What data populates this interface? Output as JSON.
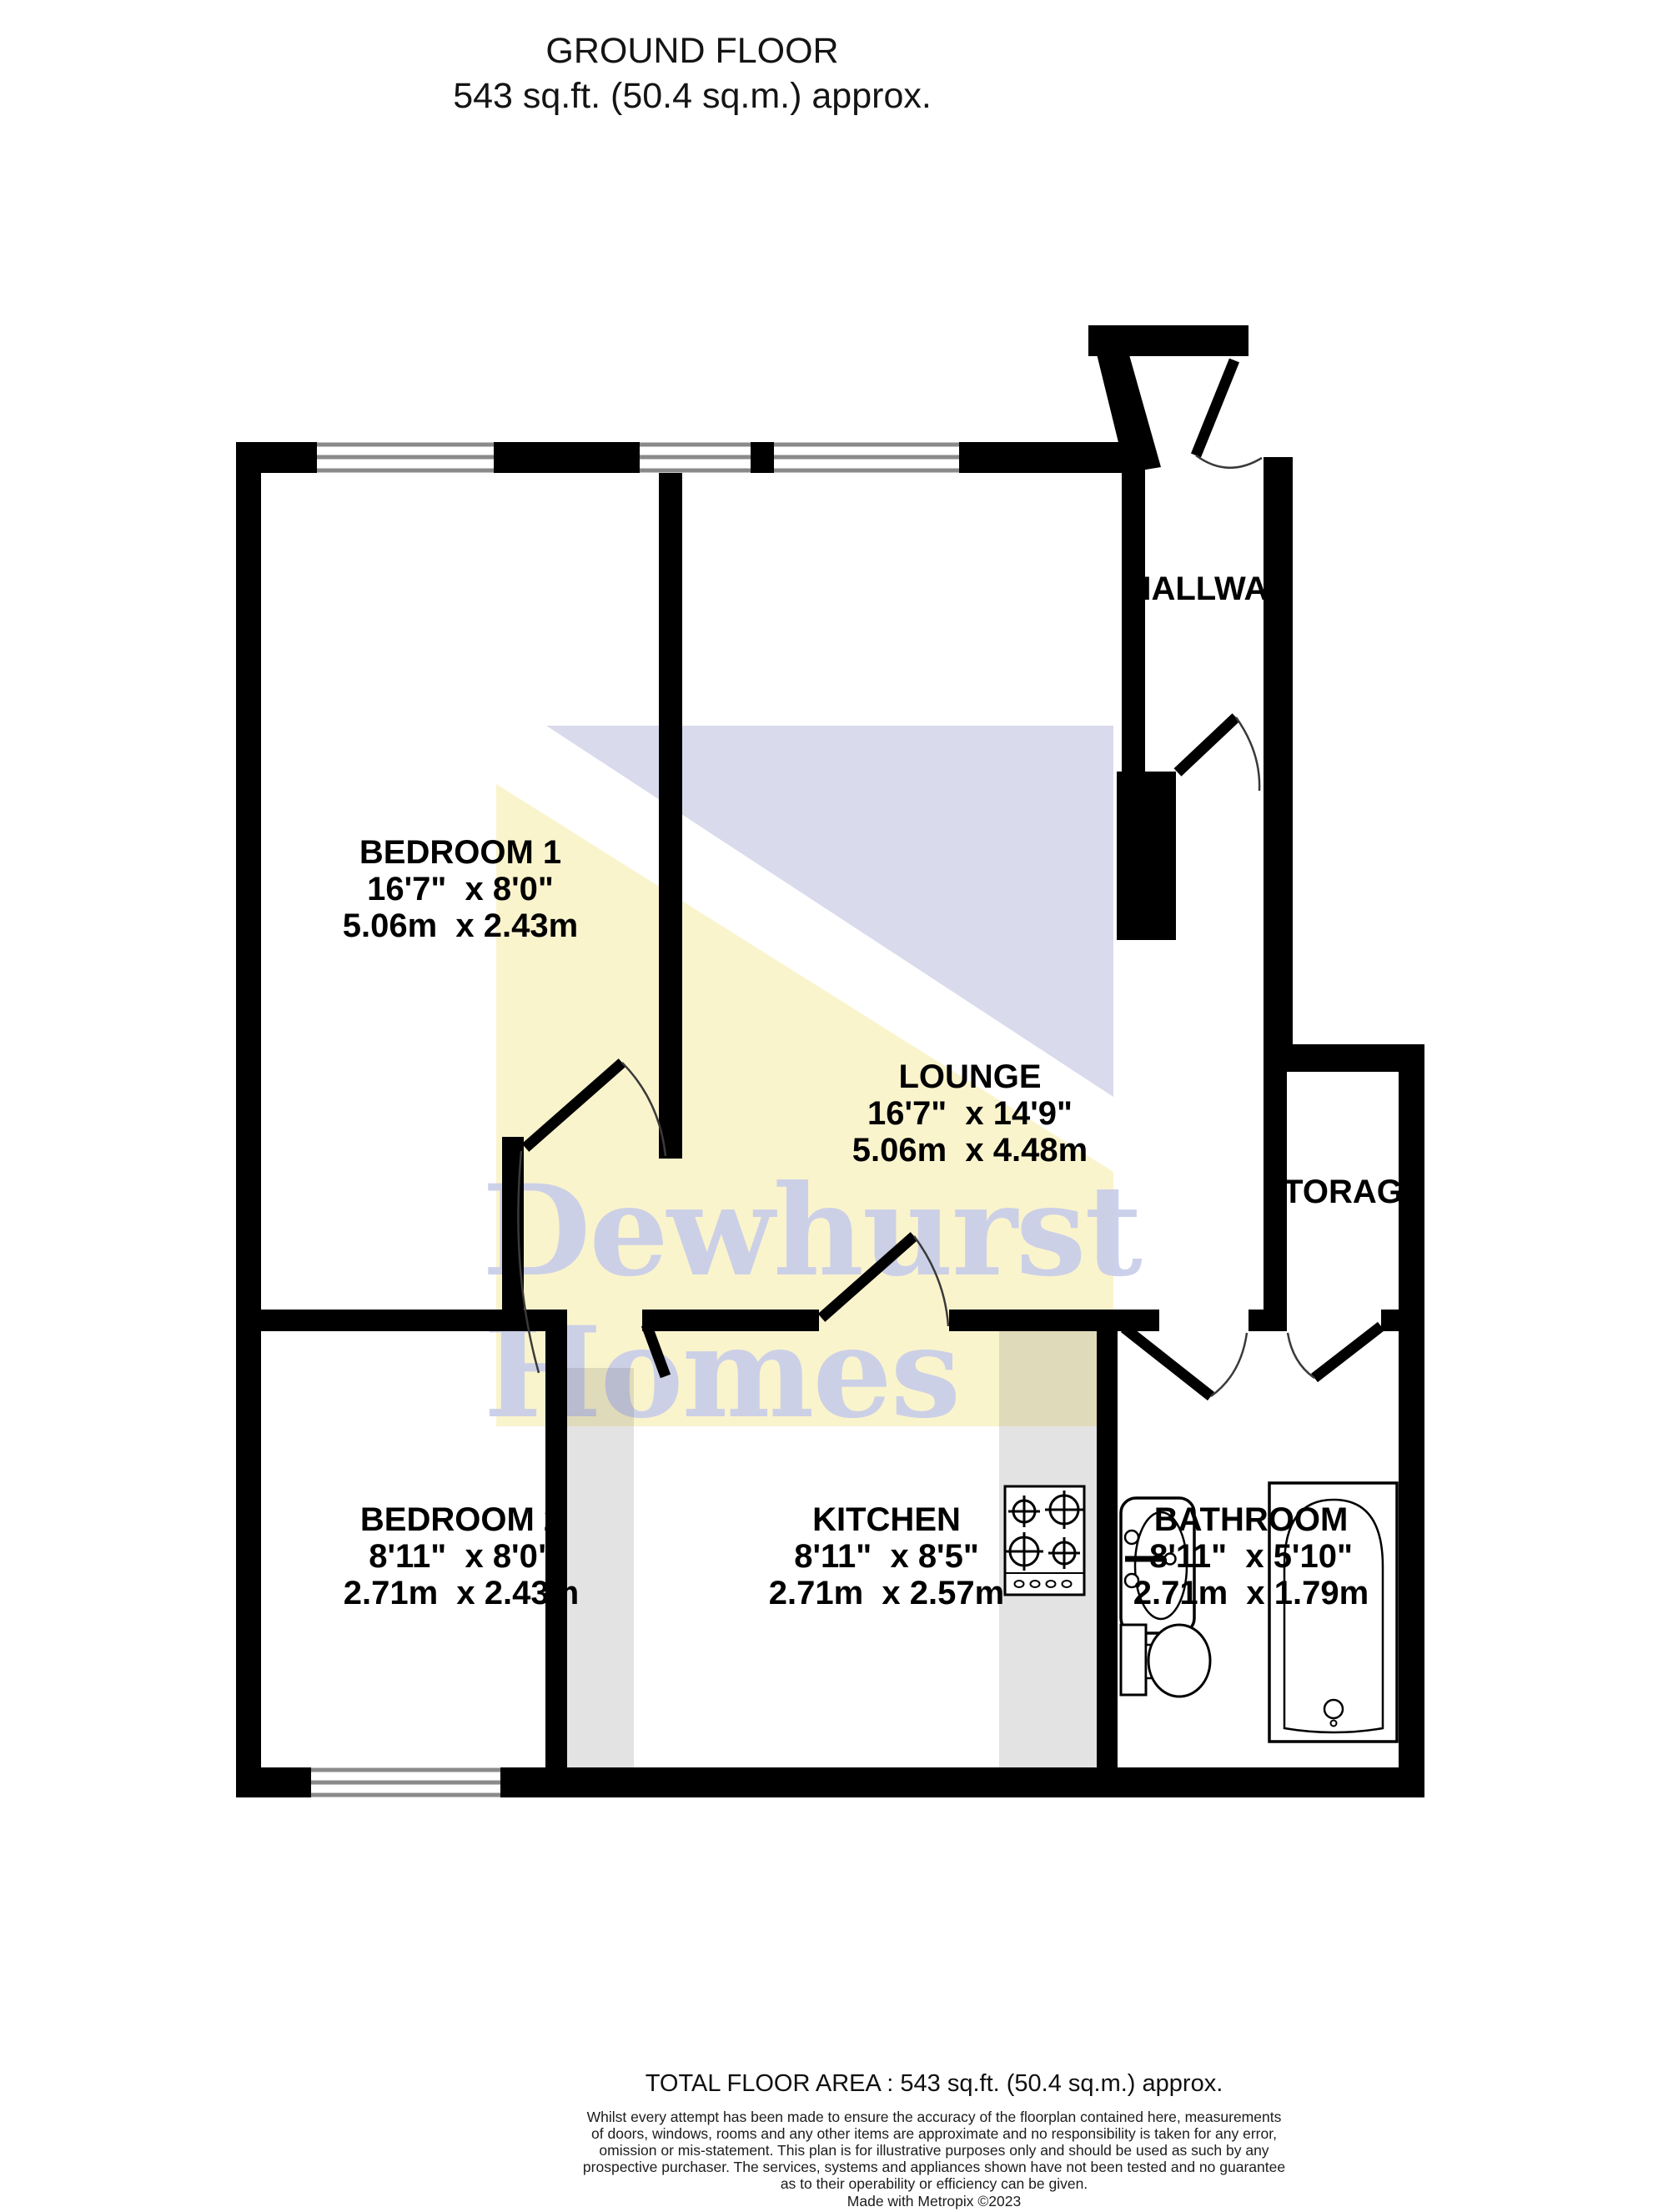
{
  "title": {
    "line1": "GROUND FLOOR",
    "line2": "543 sq.ft. (50.4 sq.m.) approx."
  },
  "watermark": {
    "line1": "Dewhurst",
    "line2": "Homes",
    "yellow": "#FAF4CD",
    "lavender": "#D9DAEC",
    "text_color": "#C7CCE9"
  },
  "rooms": {
    "bedroom1": {
      "name": "BEDROOM 1",
      "imperial": "16'7\"  x 8'0\"",
      "metric": "5.06m  x 2.43m"
    },
    "lounge": {
      "name": "LOUNGE",
      "imperial": "16'7\"  x 14'9\"",
      "metric": "5.06m  x 4.48m"
    },
    "bedroom2": {
      "name": "BEDROOM 2",
      "imperial": "8'11\"  x 8'0\"",
      "metric": "2.71m  x 2.43m"
    },
    "kitchen": {
      "name": "KITCHEN",
      "imperial": "8'11\"  x 8'5\"",
      "metric": "2.71m  x 2.57m"
    },
    "bathroom": {
      "name": "BATHROOM",
      "imperial": "8'11\"  x 5'10\"",
      "metric": "2.71m  x 1.79m"
    },
    "hallway": {
      "name": "HALLWAY"
    },
    "storage": {
      "name": "STORAGE"
    }
  },
  "colors": {
    "wall": "#000000",
    "window_frame": "#8a8a8a",
    "door_arc": "#3a3a3a",
    "counter": "rgba(100,100,100,0.18)"
  },
  "footer": {
    "total": "TOTAL FLOOR AREA : 543 sq.ft. (50.4 sq.m.) approx.",
    "disclaimer_lines": [
      "Whilst every attempt has been made to ensure the accuracy of the floorplan contained here, measurements",
      "of doors, windows, rooms and any other items are approximate and no responsibility is taken for any error,",
      "omission or mis-statement. This plan is for illustrative purposes only and should be used as such by any",
      "prospective purchaser. The services, systems and appliances shown have not been tested and no guarantee",
      "as to their operability or efficiency can be given."
    ],
    "credit": "Made with Metropix ©2023"
  }
}
